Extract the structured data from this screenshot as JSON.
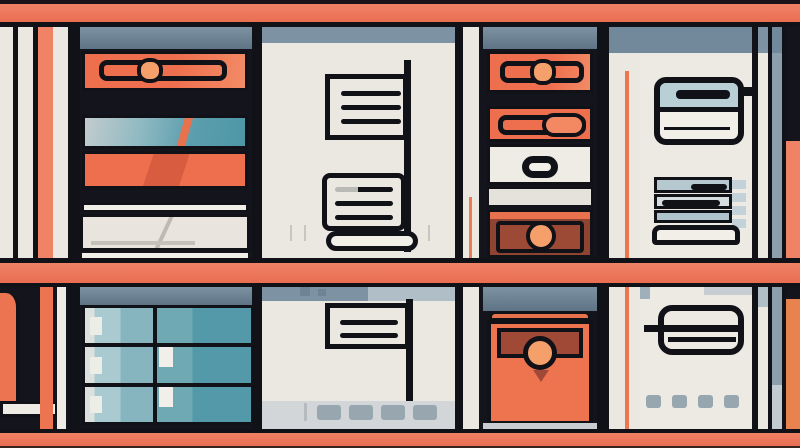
{
  "title": "Flat vector illustration of a shelving unit filled with storage boxes, binders, drawers, note cards, a printer, paper stacks and a teal file cabinet",
  "canvas": {
    "width": 800,
    "height": 448
  },
  "palette": {
    "ink": "#111118",
    "ink2": "#14141c",
    "cream": "#ebe8e2",
    "paper": "#f2efe9",
    "coral-bar": "#f08266",
    "coral-bar-d": "#e96e52",
    "coral": "#ee6f4d",
    "coral-deep": "#d85c3f",
    "peach": "#f5a06b",
    "maroon": "#8f4331",
    "maroon-2": "#9c4936",
    "slate": "#7d93a3",
    "slate-d": "#5e7486",
    "slate-l": "#afbec7",
    "teal-l": "#9cc3ca",
    "teal": "#6ba7b2",
    "teal-d": "#4e96a6",
    "ice": "#b9cfd6",
    "grayband": "#d3d6d8",
    "graysq": "#98a6af"
  },
  "scene": {
    "rows": [
      {
        "label": "top shelf row",
        "compartments": [
          "stacked storage boxes (coral binder, teal box, coral box, cream box)",
          "hanging lined note cards",
          "stack: coral binders, white drawer with oval handle, maroon drawer with round knob",
          "printer icon and stacked paper trays"
        ]
      },
      {
        "label": "bottom shelf row",
        "compartments": [
          "teal 2x3 file cabinet",
          "lined note card with vent slots below",
          "large coral drawer with round knob",
          "outlined storage box with vent slots below"
        ]
      }
    ],
    "frame": "coral shelf bars with black outlines, vertical coral and white side posts"
  }
}
